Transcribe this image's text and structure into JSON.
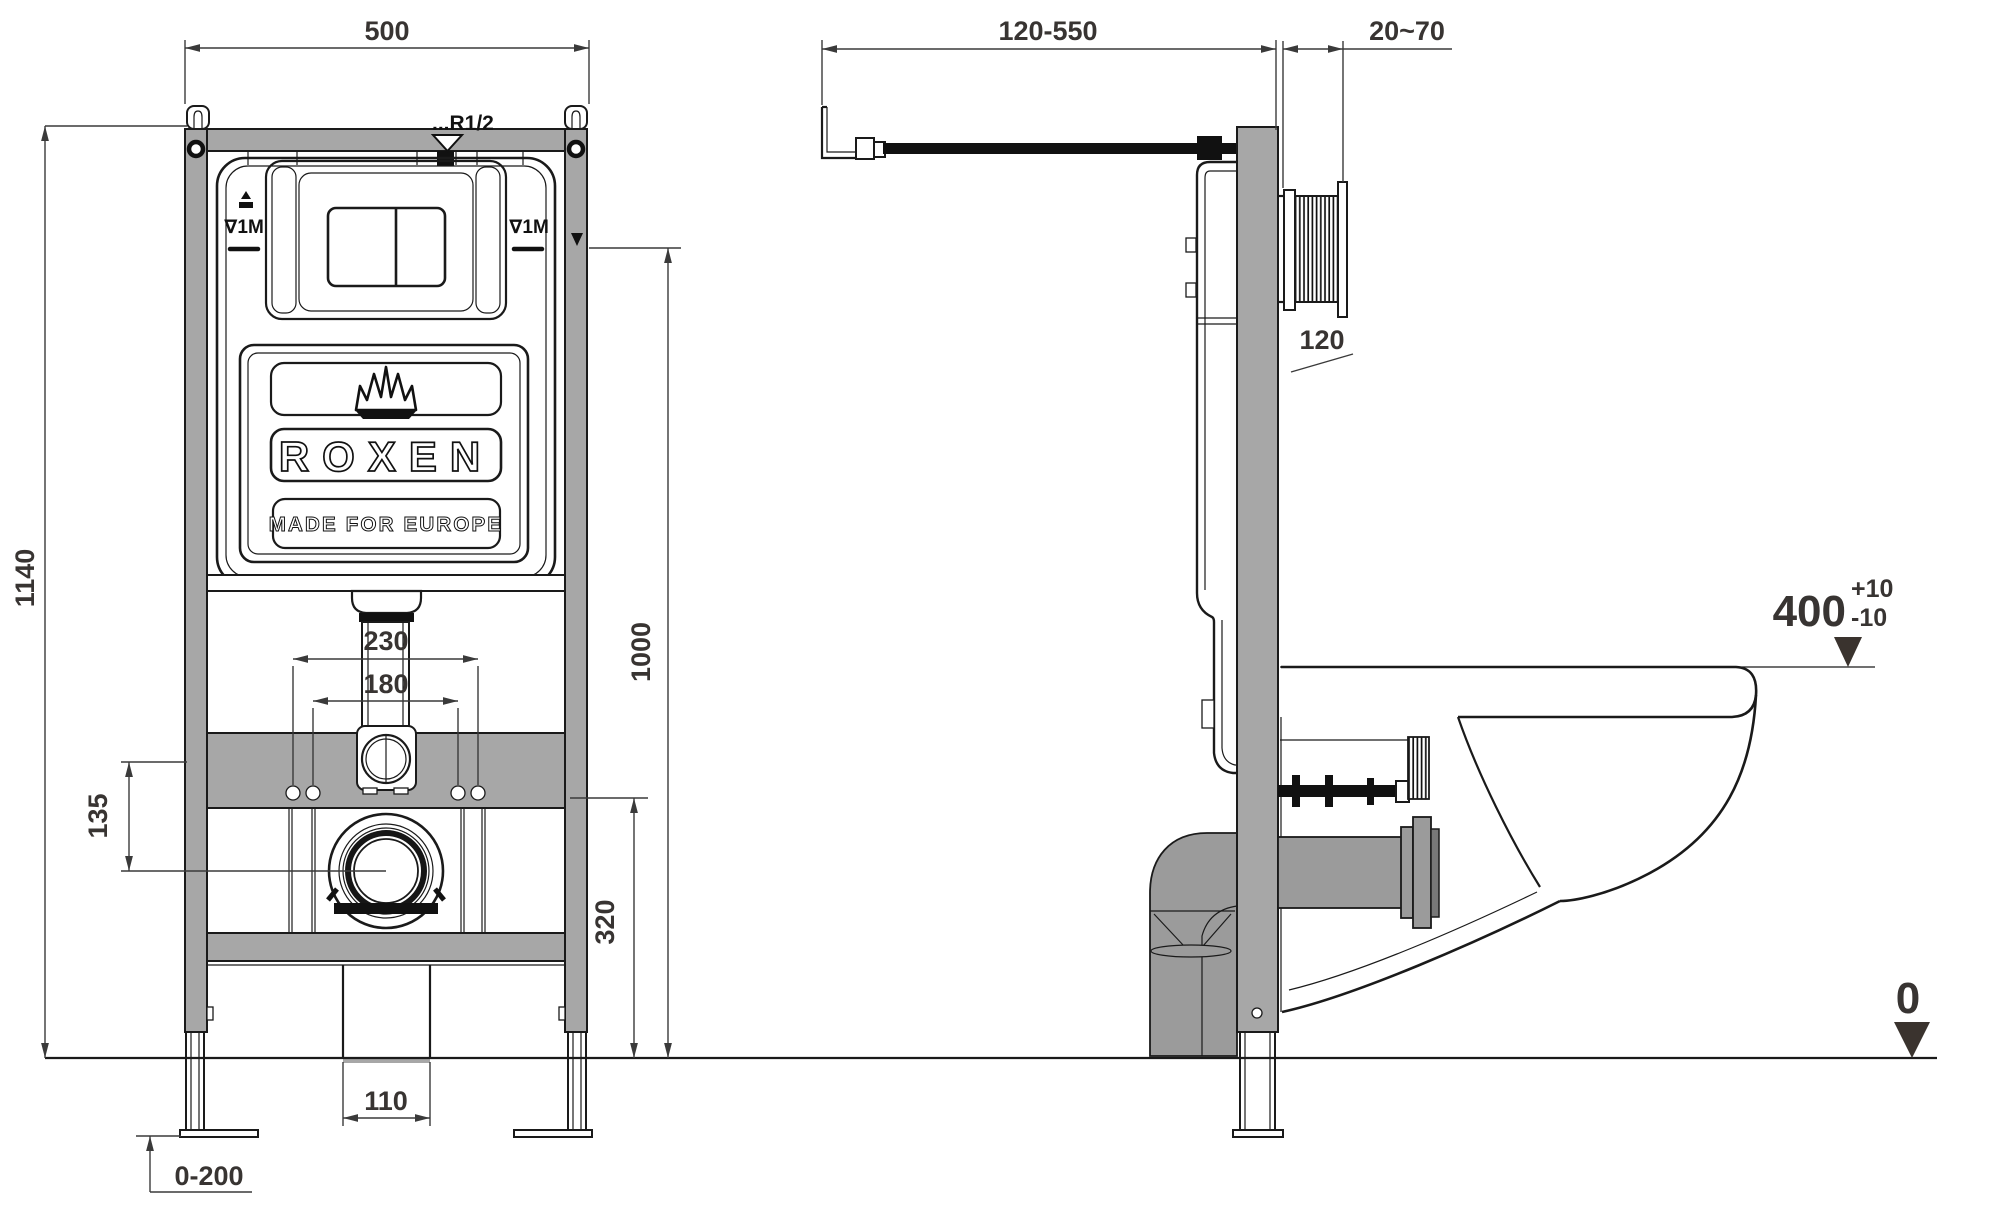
{
  "drawing_title": "Wall-hung toilet installation frame — dimensional drawing",
  "front_view": {
    "width_dim": "500",
    "frame_height_dim": "1140",
    "one_meter_height_dim": "1000",
    "fixing_spacing_outer_dim": "230",
    "fixing_spacing_inner_dim": "180",
    "inlet_to_outlet_offset_dim": "135",
    "outlet_height_dim": "320",
    "drain_pipe_width_dim": "110",
    "foot_adjust_range_dim": "0-200",
    "water_inlet_label": "...R1/2",
    "meter_mark_left": "∇1M",
    "meter_mark_right": "∇1M",
    "brand": "ROXEN",
    "brand_tagline": "MADE FOR EUROPE"
  },
  "side_view": {
    "inlet_depth_range_dim": "120-550",
    "wall_finish_range_dim": "20~70",
    "plate_housing_dim": "120",
    "seat_height_dim": "400",
    "seat_height_tol_plus": "+10",
    "seat_height_tol_minus": "-10",
    "floor_level_dim": "0"
  },
  "colors": {
    "frame_gray": "#a7a7a7",
    "pipe_gray": "#9b9b9b",
    "line_black": "#1a1a1a",
    "dimension_text": "#383432",
    "level_triangle": "#3a332e",
    "background": "#ffffff"
  }
}
